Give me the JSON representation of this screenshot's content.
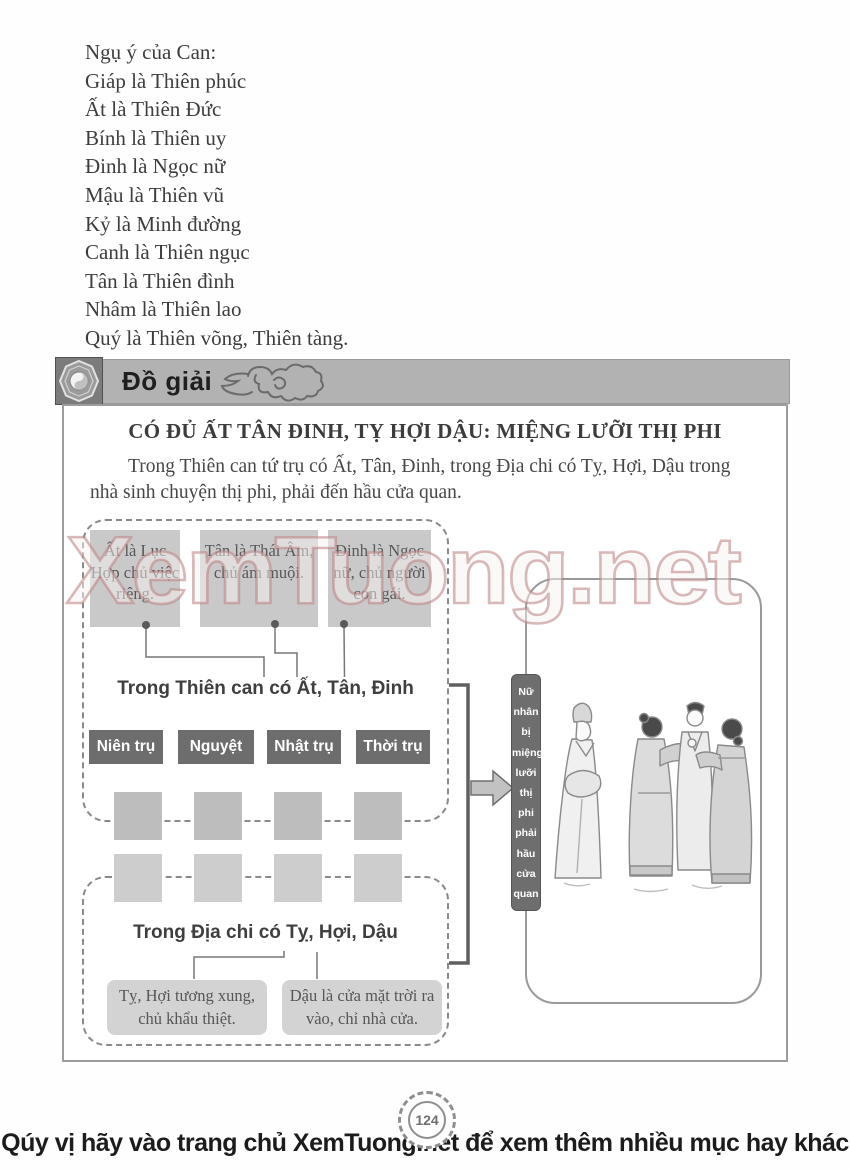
{
  "intro": {
    "lines": [
      "Ngụ ý của Can:",
      "Giáp là Thiên phúc",
      "Ất là Thiên Đức",
      "Bính là Thiên uy",
      "Đinh là Ngọc nữ",
      "Mậu là Thiên vũ",
      "Kỷ là Minh đường",
      "Canh là Thiên ngục",
      "Tân là Thiên đình",
      "Nhâm là Thiên lao",
      "Quý là Thiên võng, Thiên tàng."
    ]
  },
  "header": {
    "title": "Đồ giải",
    "icon": "bagua-yinyang-icon",
    "decoration": "cloud-scroll-icon"
  },
  "diagram": {
    "title": "CÓ ĐỦ ẤT TÂN ĐINH, TỴ HỢI DẬU: MIỆNG LƯỠI THỊ PHI",
    "paragraph": "Trong Thiên can tứ trụ có Ất, Tân, Đinh, trong Địa chi có Tỵ, Hợi, Dậu trong nhà sinh chuyện thị phi, phải đến hầu cửa quan.",
    "top_boxes": [
      "Ất là Lục Hợp chủ việc riêng.",
      "Tân là Thái Âm, chủ ám muội.",
      "Đinh là Ngọc nữ, chủ người con gái."
    ],
    "thien_can_label": "Trong Thiên can có Ất, Tân, Đinh",
    "pillars": [
      "Niên trụ",
      "Nguyệt trụ",
      "Nhật trụ",
      "Thời trụ"
    ],
    "dia_chi_label": "Trong Địa chi có Tỵ, Hợi, Dậu",
    "bottom_boxes": [
      "Tỵ, Hợi tương xung, chủ khẩu thiệt.",
      "Dậu là cửa mặt trời ra vào, chỉ nhà cửa."
    ],
    "result_words": [
      "Nữ",
      "nhân",
      "bị",
      "miệng",
      "lưỡi",
      "thị",
      "phi",
      "phải",
      "hầu",
      "cửa",
      "quan"
    ],
    "flow_icon": "arrow-right-icon",
    "illustration": "four-robed-figures-conversation"
  },
  "watermark": {
    "text": "XemTuong.net"
  },
  "page_number": "124",
  "footer": {
    "text": "Qúy vị hãy vào trang chủ XemTuong.net để xem thêm nhiều mục hay khác"
  },
  "colors": {
    "header_bar": "#b2b2b2",
    "dark_box": "#6d6d6d",
    "light_box": "#c9c9c9",
    "cell_gray": "#bdbdbd",
    "watermark_stroke": "#ba8080",
    "text": "#3d3d3d"
  }
}
